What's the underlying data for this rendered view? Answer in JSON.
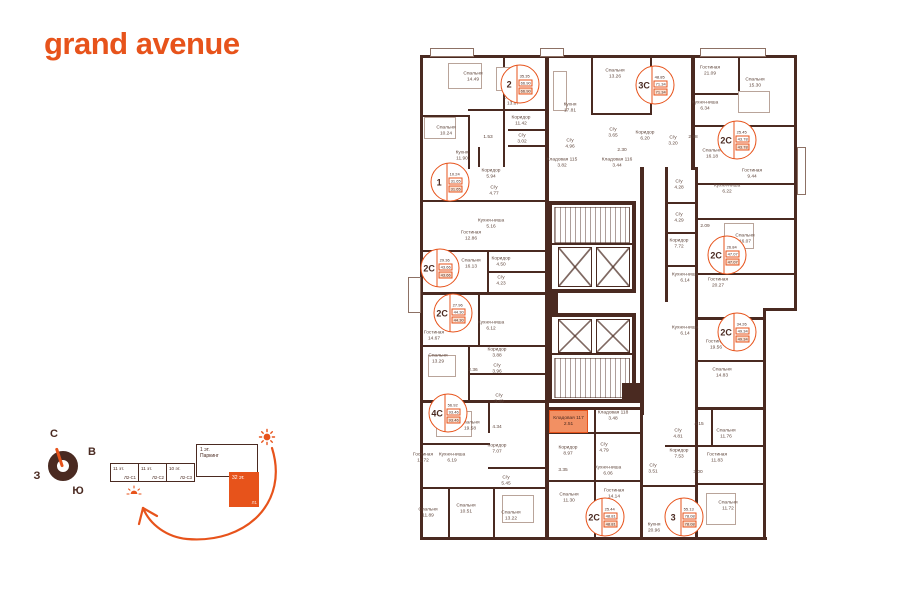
{
  "logo": "grand avenue",
  "colors": {
    "accent": "#E7531B",
    "wall": "#4A2A21",
    "storage_highlight": "#F29063"
  },
  "compass": {
    "north": "С",
    "east": "В",
    "west": "З",
    "south": "Ю"
  },
  "scheme": {
    "blocks": [
      {
        "floors": "11 эт.",
        "code": "Л2-С1"
      },
      {
        "floors": "11 эт.",
        "code": "Л2-С2"
      },
      {
        "floors": "10 эт.",
        "code": "Л2-С3"
      }
    ],
    "parking": {
      "floors": "1 эт.",
      "label": "Паркинг"
    },
    "tower": {
      "floors": "32 эт.",
      "code": "Л1"
    }
  },
  "plan": {
    "storage": {
      "name": "Кладовая 117",
      "area": "2.51"
    },
    "rooms": [
      {
        "name": "Спальня",
        "area": "14.49",
        "x": 65,
        "y": 22
      },
      {
        "name": "Спальня",
        "area": "13.87",
        "x": 105,
        "y": 46
      },
      {
        "name": "Коридор",
        "area": "11.42",
        "x": 113,
        "y": 66
      },
      {
        "name": "Спальня",
        "area": "10.24",
        "x": 38,
        "y": 76
      },
      {
        "name": "С/у",
        "area": "3.02",
        "x": 114,
        "y": 84
      },
      {
        "name": "",
        "area": "1.53",
        "x": 80,
        "y": 83
      },
      {
        "name": "Кухня",
        "area": "11.90",
        "x": 54,
        "y": 101
      },
      {
        "name": "Коридор",
        "area": "5.94",
        "x": 83,
        "y": 119
      },
      {
        "name": "С/у",
        "area": "4.77",
        "x": 86,
        "y": 136
      },
      {
        "name": "Кухня-ниша",
        "area": "5.16",
        "x": 83,
        "y": 169
      },
      {
        "name": "Гостиная",
        "area": "12.86",
        "x": 63,
        "y": 181
      },
      {
        "name": "Спальня",
        "area": "16.13",
        "x": 63,
        "y": 209
      },
      {
        "name": "Коридор",
        "area": "4.50",
        "x": 93,
        "y": 207
      },
      {
        "name": "С/у",
        "area": "4.23",
        "x": 93,
        "y": 226
      },
      {
        "name": "Спальня",
        "area": "13.26",
        "x": 207,
        "y": 19
      },
      {
        "name": "Кухня",
        "area": "17.81",
        "x": 162,
        "y": 53
      },
      {
        "name": "С/у",
        "area": "3.65",
        "x": 205,
        "y": 78
      },
      {
        "name": "Коридор",
        "area": "6.20",
        "x": 237,
        "y": 81
      },
      {
        "name": "С/у",
        "area": "3.20",
        "x": 265,
        "y": 86
      },
      {
        "name": "С/у",
        "area": "4.96",
        "x": 162,
        "y": 89
      },
      {
        "name": "",
        "area": "2.30",
        "x": 214,
        "y": 96
      },
      {
        "name": "Кладовая 115",
        "area": "3.82",
        "x": 154,
        "y": 108
      },
      {
        "name": "Кладовая 116",
        "area": "3.44",
        "x": 209,
        "y": 108
      },
      {
        "name": "Гостиная",
        "area": "21.09",
        "x": 302,
        "y": 16
      },
      {
        "name": "Спальня",
        "area": "15.30",
        "x": 347,
        "y": 28
      },
      {
        "name": "Кухня-ниша",
        "area": "6.34",
        "x": 297,
        "y": 51
      },
      {
        "name": "",
        "area": "2.98",
        "x": 285,
        "y": 83
      },
      {
        "name": "Спальня",
        "area": "16.18",
        "x": 304,
        "y": 99
      },
      {
        "name": "Гостиная",
        "area": "9.44",
        "x": 344,
        "y": 119
      },
      {
        "name": "Кухня-ниша",
        "area": "6.22",
        "x": 319,
        "y": 134
      },
      {
        "name": "С/у",
        "area": "4.28",
        "x": 271,
        "y": 130
      },
      {
        "name": "С/у",
        "area": "4.29",
        "x": 271,
        "y": 163
      },
      {
        "name": "",
        "area": "2.09",
        "x": 297,
        "y": 172
      },
      {
        "name": "Спальня",
        "area": "16.07",
        "x": 337,
        "y": 184
      },
      {
        "name": "Коридор",
        "area": "7.72",
        "x": 271,
        "y": 189
      },
      {
        "name": "Кухня-ниша",
        "area": "6.14",
        "x": 277,
        "y": 223
      },
      {
        "name": "Гостиная",
        "area": "20.27",
        "x": 310,
        "y": 228
      },
      {
        "name": "Кухня-ниша",
        "area": "6.14",
        "x": 277,
        "y": 276
      },
      {
        "name": "Гостиная",
        "area": "19.56",
        "x": 308,
        "y": 290
      },
      {
        "name": "Спальня",
        "area": "14.83",
        "x": 314,
        "y": 318
      },
      {
        "name": "Гостиная",
        "area": "14.67",
        "x": 26,
        "y": 281
      },
      {
        "name": "Кухня-ниша",
        "area": "6.12",
        "x": 83,
        "y": 271
      },
      {
        "name": "Коридор",
        "area": "3.88",
        "x": 89,
        "y": 298
      },
      {
        "name": "Спальня",
        "area": "13.29",
        "x": 30,
        "y": 304
      },
      {
        "name": "",
        "area": "2.36",
        "x": 65,
        "y": 316
      },
      {
        "name": "С/у",
        "area": "3.96",
        "x": 89,
        "y": 314
      },
      {
        "name": "С/у",
        "area": "3.49",
        "x": 91,
        "y": 344
      },
      {
        "name": "Спальня",
        "area": "19.58",
        "x": 62,
        "y": 371
      },
      {
        "name": "",
        "area": "4.34",
        "x": 89,
        "y": 373
      },
      {
        "name": "Коридор",
        "area": "7.07",
        "x": 89,
        "y": 394
      },
      {
        "name": "Гостиная",
        "area": "11.72",
        "x": 15,
        "y": 403
      },
      {
        "name": "Кухня-ниша",
        "area": "6.19",
        "x": 44,
        "y": 403
      },
      {
        "name": "С/у",
        "area": "5.45",
        "x": 98,
        "y": 426
      },
      {
        "name": "Спальня",
        "area": "11.89",
        "x": 20,
        "y": 458
      },
      {
        "name": "Спальня",
        "area": "10.51",
        "x": 58,
        "y": 454
      },
      {
        "name": "Спальня",
        "area": "13.22",
        "x": 103,
        "y": 461
      },
      {
        "name": "Кладовая 118",
        "area": "3.48",
        "x": 205,
        "y": 361
      },
      {
        "name": "Коридор",
        "area": "8.97",
        "x": 160,
        "y": 396
      },
      {
        "name": "С/у",
        "area": "4.79",
        "x": 196,
        "y": 393
      },
      {
        "name": "",
        "area": "3.35",
        "x": 155,
        "y": 416
      },
      {
        "name": "Кухня-ниша",
        "area": "6.06",
        "x": 200,
        "y": 416
      },
      {
        "name": "С/у",
        "area": "3.51",
        "x": 245,
        "y": 414
      },
      {
        "name": "Спальня",
        "area": "11.30",
        "x": 161,
        "y": 443
      },
      {
        "name": "Гостиная",
        "area": "14.14",
        "x": 206,
        "y": 439
      },
      {
        "name": "Кухня",
        "area": "20.96",
        "x": 246,
        "y": 473
      },
      {
        "name": "С/у",
        "area": "4.81",
        "x": 270,
        "y": 379
      },
      {
        "name": "Коридор",
        "area": "7.53",
        "x": 271,
        "y": 399
      },
      {
        "name": "",
        "area": "4.15",
        "x": 291,
        "y": 370
      },
      {
        "name": "Спальня",
        "area": "11.76",
        "x": 318,
        "y": 379
      },
      {
        "name": "Гостиная",
        "area": "11.83",
        "x": 309,
        "y": 403
      },
      {
        "name": "",
        "area": "3.00",
        "x": 290,
        "y": 418
      },
      {
        "name": "Спальня",
        "area": "11.72",
        "x": 320,
        "y": 451
      }
    ],
    "badges": [
      {
        "type": "2",
        "values": [
          "35.35",
          "66.90",
          "66.90"
        ],
        "x": 112,
        "y": 29
      },
      {
        "type": "3С",
        "values": [
          "48.85",
          "71.34",
          "71.34"
        ],
        "x": 247,
        "y": 30
      },
      {
        "type": "2С",
        "values": [
          "25.45",
          "43.78",
          "43.78"
        ],
        "x": 329,
        "y": 85
      },
      {
        "type": "1",
        "values": [
          "10.24",
          "31.65",
          "31.65"
        ],
        "x": 42,
        "y": 127
      },
      {
        "type": "2С",
        "values": [
          "29.36",
          "43.66",
          "43.66"
        ],
        "x": 32,
        "y": 213
      },
      {
        "type": "2С",
        "values": [
          "26.84",
          "47.07",
          "47.07"
        ],
        "x": 319,
        "y": 200
      },
      {
        "type": "2С",
        "values": [
          "27.96",
          "44.30",
          "44.30"
        ],
        "x": 45,
        "y": 258
      },
      {
        "type": "2С",
        "values": [
          "34.26",
          "49.34",
          "49.34"
        ],
        "x": 329,
        "y": 277
      },
      {
        "type": "4С",
        "values": [
          "56.92",
          "93.46",
          "93.46"
        ],
        "x": 40,
        "y": 358
      },
      {
        "type": "2С",
        "values": [
          "25.44",
          "48.81",
          "48.81"
        ],
        "x": 197,
        "y": 462
      },
      {
        "type": "3",
        "values": [
          "55.13",
          "78.08",
          "78.08"
        ],
        "x": 276,
        "y": 462
      }
    ]
  }
}
